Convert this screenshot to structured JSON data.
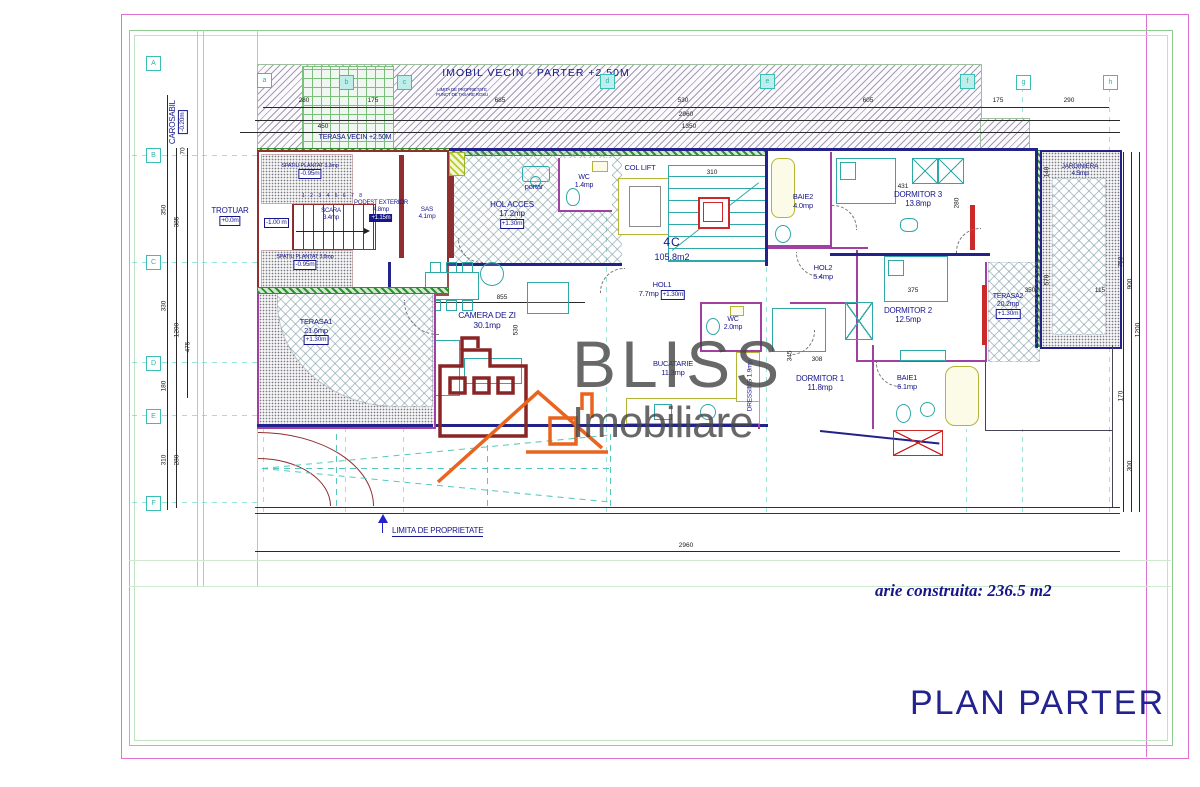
{
  "footer": {
    "area_note": "arie construita: 236.5 m2",
    "title": "PLAN PARTER"
  },
  "brand": {
    "name1": "BLISS",
    "name2": "Imobiliare"
  },
  "site": {
    "neighbor": "IMOBIL VECIN - PARTER +2.50M",
    "neighbor_terrace": "TERASA VECIN +2.50M",
    "note1": "LIMITA DE PROPRIETATE",
    "note2": "PUNCT DE TASARE ROSU",
    "carosabil": {
      "name": "CAROSABIL",
      "level": "-0.20m"
    },
    "trotuar": {
      "name": "TROTUAR",
      "level": "+0.0m"
    },
    "scara_level": "-1.00 m",
    "property_limit": "LIMITA DE PROPRIETATE"
  },
  "unit": {
    "code": "4C",
    "area": "105.8m2"
  },
  "stairs": {
    "numbers": "1 2 3 4 5 6 7 8"
  },
  "rooms": [
    {
      "name": "SPATIU PLANTAT",
      "area": "3.3mp",
      "level": "-0.95m"
    },
    {
      "name": "SCARA",
      "area": "3.4mp"
    },
    {
      "name": "SPATIU PLANTAT",
      "area": "3.8mp",
      "level": "-0.95m"
    },
    {
      "name": "PODEST EXTERIOR",
      "area": "4.8mp",
      "level": "+1.15m"
    },
    {
      "name": "SAS",
      "area": "4.1mp"
    },
    {
      "name": "HOL ACCES",
      "area": "17.2mp",
      "level": "+1.30m"
    },
    {
      "name": "portar"
    },
    {
      "name": "WC",
      "area": "1.4mp"
    },
    {
      "name": "COL LIFT"
    },
    {
      "name": "BAIE2",
      "area": "4.0mp"
    },
    {
      "name": "DORMITOR 3",
      "area": "13.8mp"
    },
    {
      "name": "JARDINIERA",
      "area": "4.5mp"
    },
    {
      "name": "HOL2",
      "area": "5.4mp"
    },
    {
      "name": "HOL1",
      "area": "7.7mp",
      "level": "+1.30m"
    },
    {
      "name": "CAMERA DE ZI",
      "area": "30.1mp"
    },
    {
      "name": "DORMITOR 2",
      "area": "12.5mp"
    },
    {
      "name": "TERASA2",
      "area": "20.2mp",
      "level": "+1.30m"
    },
    {
      "name": "TERASA1",
      "area": "21.6mp",
      "level": "+1.30m"
    },
    {
      "name": "WC",
      "area": "2.0mp"
    },
    {
      "name": "BUCATARIE",
      "area": "11.3mp"
    },
    {
      "name": "DRESSING",
      "area": "1.9mp"
    },
    {
      "name": "DORMITOR 1",
      "area": "11.8mp"
    },
    {
      "name": "BAIE1",
      "area": "6.1mp"
    }
  ],
  "dims": {
    "top": [
      "280",
      "175",
      "685",
      "530",
      "605",
      "175",
      "290"
    ],
    "top_total": "2960",
    "top_sub": "450",
    "top_total2": "1350",
    "left": [
      "70",
      "350",
      "385",
      "330",
      "1200",
      "475",
      "180",
      "310",
      "280"
    ],
    "right": [
      "750",
      "900",
      "1200",
      "170",
      "300"
    ],
    "bottom": "2960",
    "interior": [
      "855",
      "530",
      "310",
      "375",
      "350",
      "115",
      "308",
      "345",
      "431",
      "280",
      "140",
      "570"
    ]
  },
  "axes": {
    "top": [
      "a",
      "b",
      "c",
      "d",
      "e",
      "f",
      "g",
      "h"
    ],
    "left": [
      "A",
      "B",
      "C",
      "D",
      "E",
      "F"
    ]
  },
  "colors": {
    "label_navy": "#16168c",
    "wall_navy": "#22228a",
    "wall_brick": "#8f2f2f",
    "wall_magenta": "#a040a0",
    "accent_red": "#cc2a2a",
    "axis_cyan": "#3bbfb4",
    "hedge_green": "#2f8f2f",
    "brand_orange": "#e8641f",
    "brand_red": "#8b2525",
    "title_navy": "#23238f",
    "frame_pink": "#e06fd6",
    "frame_green": "#8fca8f"
  }
}
